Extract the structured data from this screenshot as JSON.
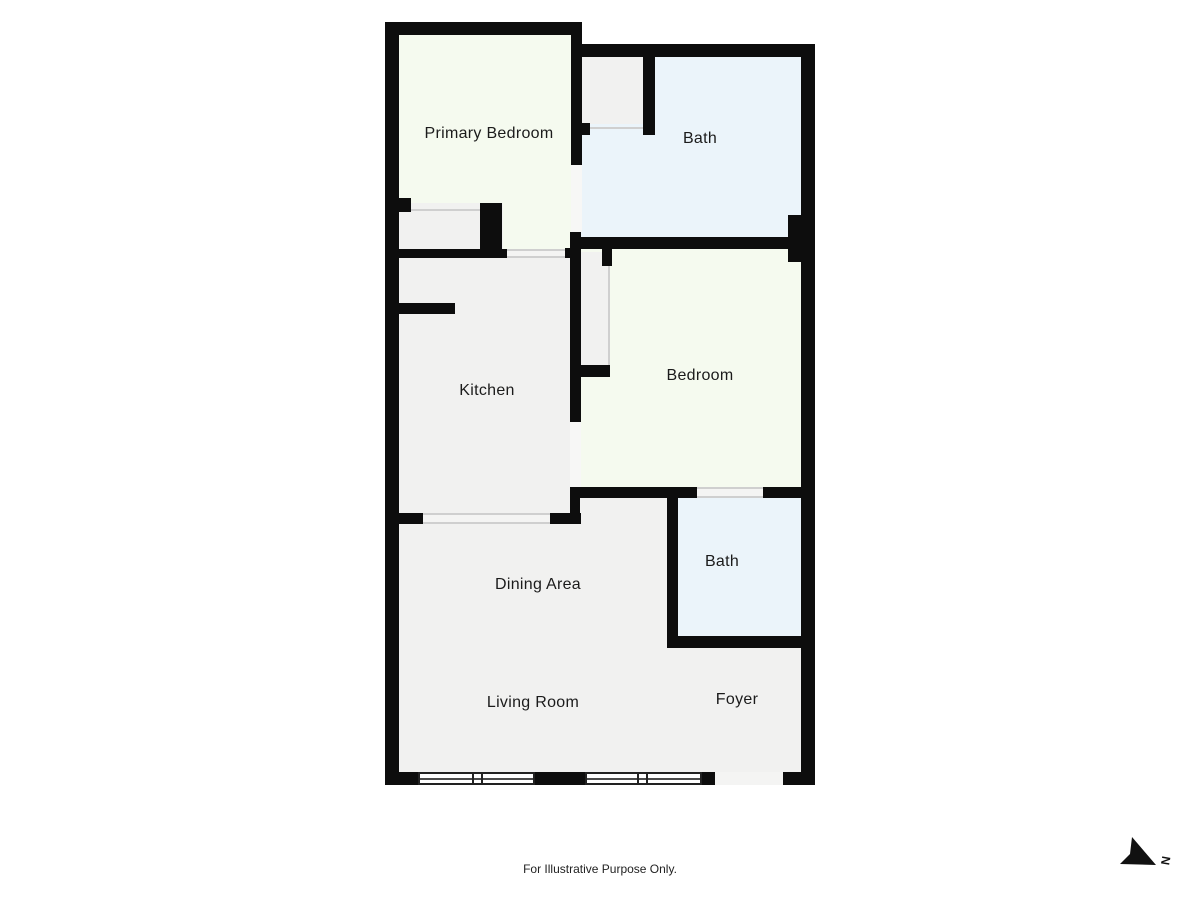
{
  "plan": {
    "rooms": {
      "primary_bedroom": "Primary Bedroom",
      "bath_top": "Bath",
      "kitchen": "Kitchen",
      "bedroom": "Bedroom",
      "bath_lower": "Bath",
      "dining": "Dining Area",
      "living": "Living Room",
      "foyer": "Foyer"
    },
    "colors": {
      "background": "#ffffff",
      "wall": "#0d0d0d",
      "floor_gray": "#f1f1f0",
      "floor_green": "#f5faef",
      "floor_blue": "#ebf4fa",
      "label_text": "#1b1b1b"
    },
    "footer": {
      "disclaimer": "For Illustrative Purpose Only."
    },
    "compass": {
      "letter": "N"
    }
  }
}
